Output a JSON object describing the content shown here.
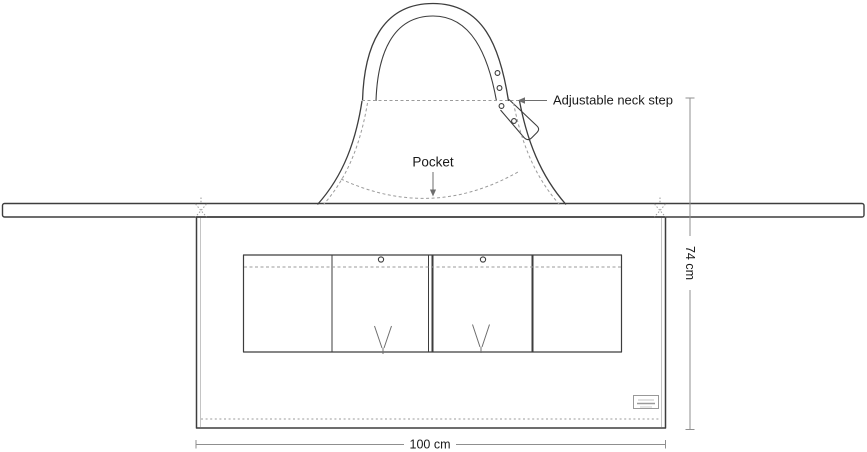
{
  "diagram": {
    "labels": {
      "neck_strap": "Adjustable neck step",
      "pocket": "Pocket"
    },
    "dimensions": {
      "height": "74 cm",
      "width": "100 cm"
    },
    "colors": {
      "outline": "#3d3d3d",
      "seam": "#9b9b9b",
      "light_seam": "#c4c4c4",
      "dimension": "#8f8f8f",
      "annotation": "#6e6e6e",
      "text": "#1a1a1a",
      "background": "#ffffff"
    }
  }
}
